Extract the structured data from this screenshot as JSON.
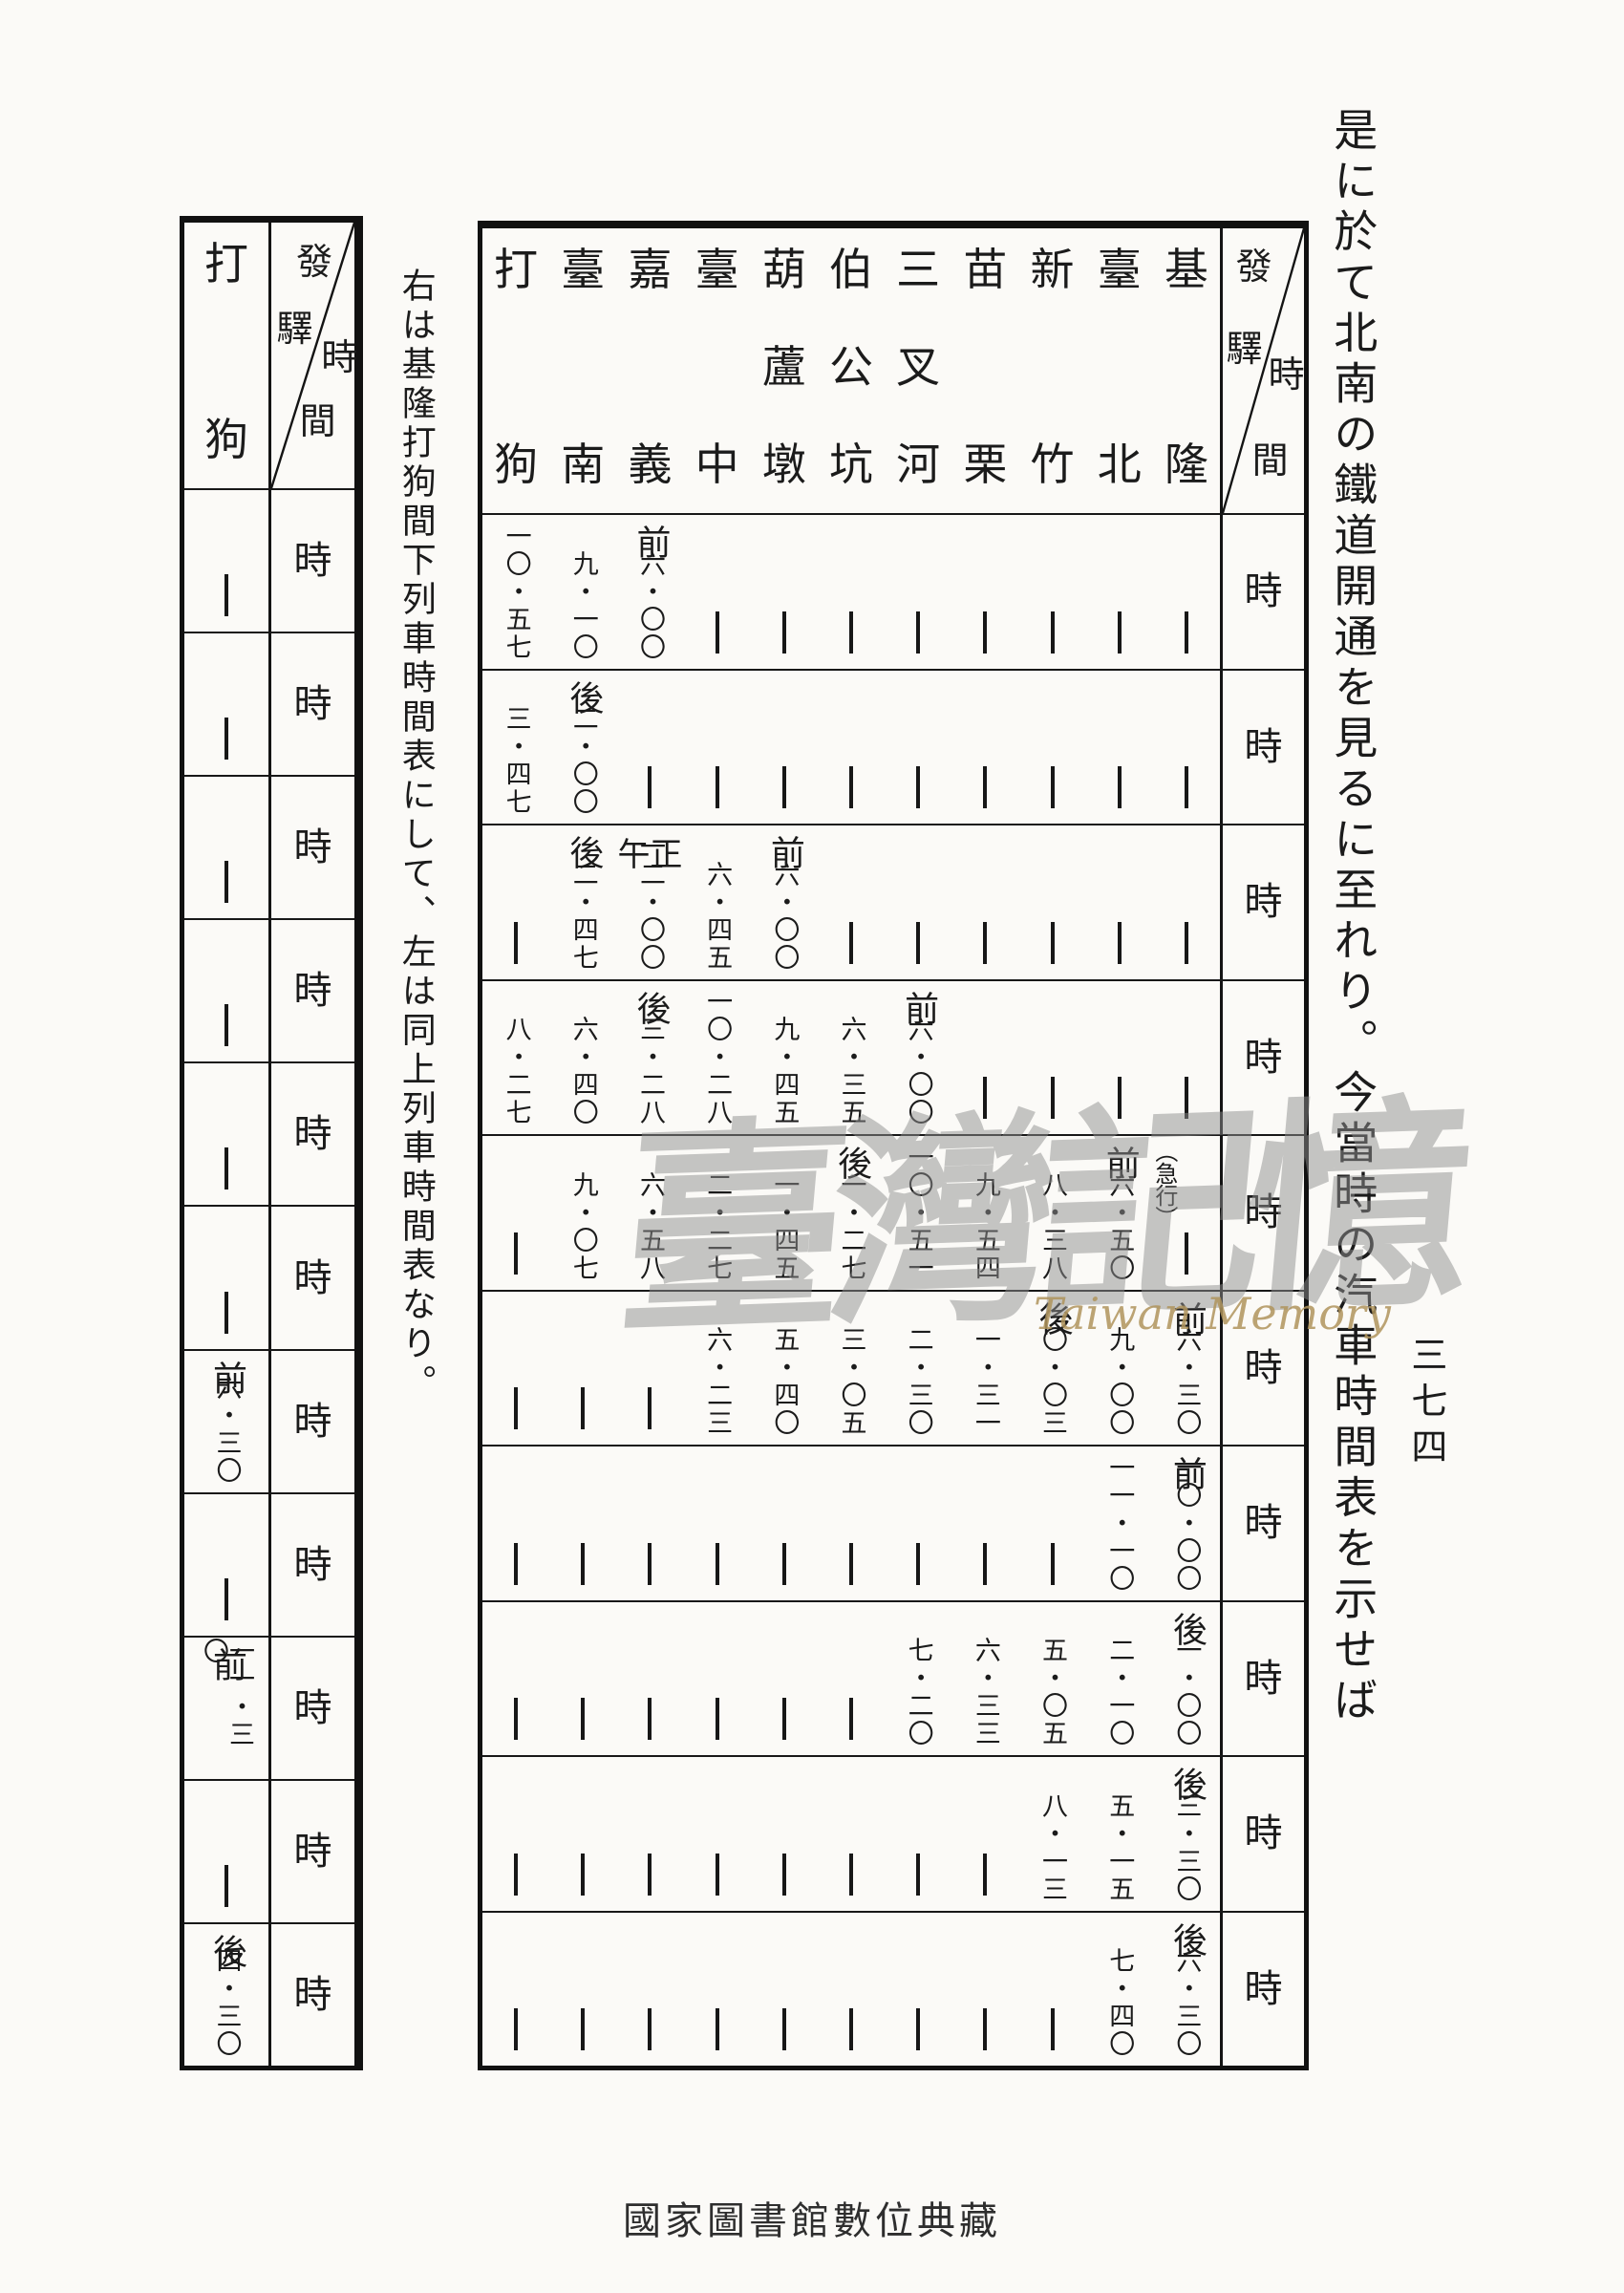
{
  "page": {
    "right_text": "是に於て北南の鐵道開通を見るに至れり。今當時の汽車時間表を示せば",
    "left_text": "右は基隆打狗間下列車時間表にして、左は同上列車時間表なり。",
    "page_number": "三七四",
    "watermark_cjk": "臺灣記憶",
    "watermark_en": "Taiwan Memory",
    "bottom_caption": "國家圖書館數位典藏"
  },
  "main_table": {
    "corner_top_left": "發驛",
    "corner_bottom_right": "時間",
    "hour_label": "時",
    "stations": [
      "基隆",
      "臺北",
      "新竹",
      "苗栗",
      "三叉河",
      "伯公坑",
      "葫蘆墩",
      "臺中",
      "嘉義",
      "臺南",
      "打狗"
    ],
    "rows": [
      [
        null,
        null,
        null,
        null,
        null,
        null,
        null,
        null,
        {
          "l": "前",
          "t": "六・〇〇"
        },
        {
          "t": "九・一〇"
        },
        {
          "t": "一〇・五七"
        }
      ],
      [
        null,
        null,
        null,
        null,
        null,
        null,
        null,
        null,
        null,
        {
          "l": "後",
          "t": "二・〇〇"
        },
        {
          "t": "三・四七"
        }
      ],
      [
        null,
        null,
        null,
        null,
        null,
        null,
        {
          "l": "前",
          "t": "六・〇〇"
        },
        {
          "t": "六・四五"
        },
        {
          "l": "正午",
          "t": "一二・〇〇"
        },
        {
          "l": "後",
          "t": "二・四七"
        },
        null
      ],
      [
        null,
        null,
        null,
        null,
        {
          "l": "前",
          "t": "六・〇〇"
        },
        {
          "t": "六・三五"
        },
        {
          "t": "九・四五"
        },
        {
          "t": "一〇・二八"
        },
        {
          "l": "後",
          "t": "三・二八"
        },
        {
          "t": "六・四〇"
        },
        {
          "t": "八・二七"
        }
      ],
      [
        {
          "n": "（急行）"
        },
        {
          "l": "前",
          "t": "六・五〇"
        },
        {
          "t": "八・三八"
        },
        {
          "t": "九・五四"
        },
        {
          "t": "一〇・五一"
        },
        {
          "l": "後",
          "t": "一・二七"
        },
        {
          "t": "一・四五"
        },
        {
          "t": "二・二七"
        },
        {
          "t": "六・五八"
        },
        {
          "t": "九・〇七"
        },
        null
      ],
      [
        {
          "l": "前",
          "t": "六・三〇"
        },
        {
          "t": "九・〇〇"
        },
        {
          "l": "後",
          "t": "〇・〇三"
        },
        {
          "t": "一・三一"
        },
        {
          "t": "二・三〇"
        },
        {
          "t": "三・〇五"
        },
        {
          "t": "五・四〇"
        },
        {
          "t": "六・二三"
        },
        null,
        null,
        null
      ],
      [
        {
          "l": "前",
          "t": "一〇・〇〇"
        },
        {
          "t": "一一・一〇"
        },
        null,
        null,
        null,
        null,
        null,
        null,
        null,
        null,
        null
      ],
      [
        {
          "l": "後",
          "t": "一・〇〇"
        },
        {
          "t": "二・一〇"
        },
        {
          "t": "五・〇五"
        },
        {
          "t": "六・三三"
        },
        {
          "t": "七・二〇"
        },
        null,
        null,
        null,
        null,
        null,
        null
      ],
      [
        {
          "l": "後",
          "t": "三・三〇"
        },
        {
          "t": "五・一五"
        },
        {
          "t": "八・一三"
        },
        null,
        null,
        null,
        null,
        null,
        null,
        null,
        null
      ],
      [
        {
          "l": "後",
          "t": "六・三〇"
        },
        {
          "t": "七・四〇"
        },
        null,
        null,
        null,
        null,
        null,
        null,
        null,
        null,
        null
      ]
    ]
  },
  "left_table": {
    "corner_top_left": "發驛",
    "corner_bottom_right": "時間",
    "hour_label": "時",
    "station": "打狗",
    "rows": [
      null,
      null,
      null,
      null,
      null,
      null,
      {
        "l": "前",
        "t": "六・三〇"
      },
      null,
      {
        "l": "前",
        "t": "一一・三〇"
      },
      null,
      {
        "l": "後",
        "t": "四・三〇"
      }
    ]
  }
}
